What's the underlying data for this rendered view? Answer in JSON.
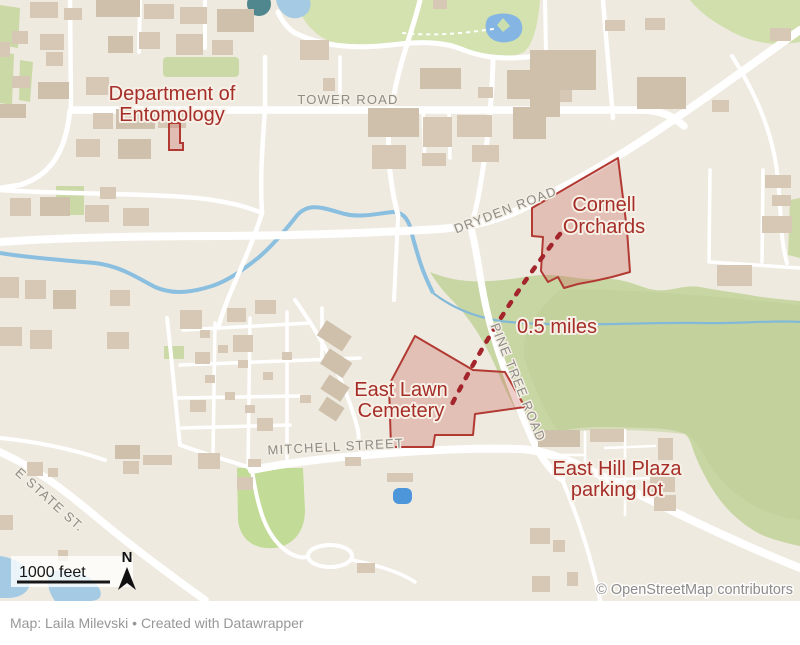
{
  "map": {
    "labels": {
      "entomology": {
        "line1": "Department of",
        "line2": "Entomology"
      },
      "orchards": {
        "line1": "Cornell",
        "line2": "Orchards"
      },
      "cemetery": {
        "line1": "East Lawn",
        "line2": "Cemetery"
      },
      "plaza": {
        "line1": "East Hill Plaza",
        "line2": "parking lot"
      },
      "distance": "0.5 miles"
    },
    "road_labels": {
      "tower": "TOWER ROAD",
      "dryden": "DRYDEN ROAD",
      "mitchell": "MITCHELL STREET",
      "pine_tree": "PINE TREE ROAD",
      "e_state": "E STATE ST."
    },
    "scale_label": "1000 feet",
    "compass_label": "N",
    "attribution": "© OpenStreetMap contributors",
    "colors": {
      "background": "#efeae0",
      "road": "#ffffff",
      "building": "#d6c8b5",
      "green": "#cbd9a7",
      "water": "#a5cbe4",
      "accent_red": "#a52e28",
      "polygon_stroke": "#b23a33",
      "polygon_fill": "#c96a60",
      "dash_red": "#a3242b"
    }
  },
  "footer": {
    "credit": "Map: Laila Milevski • Created with Datawrapper"
  }
}
